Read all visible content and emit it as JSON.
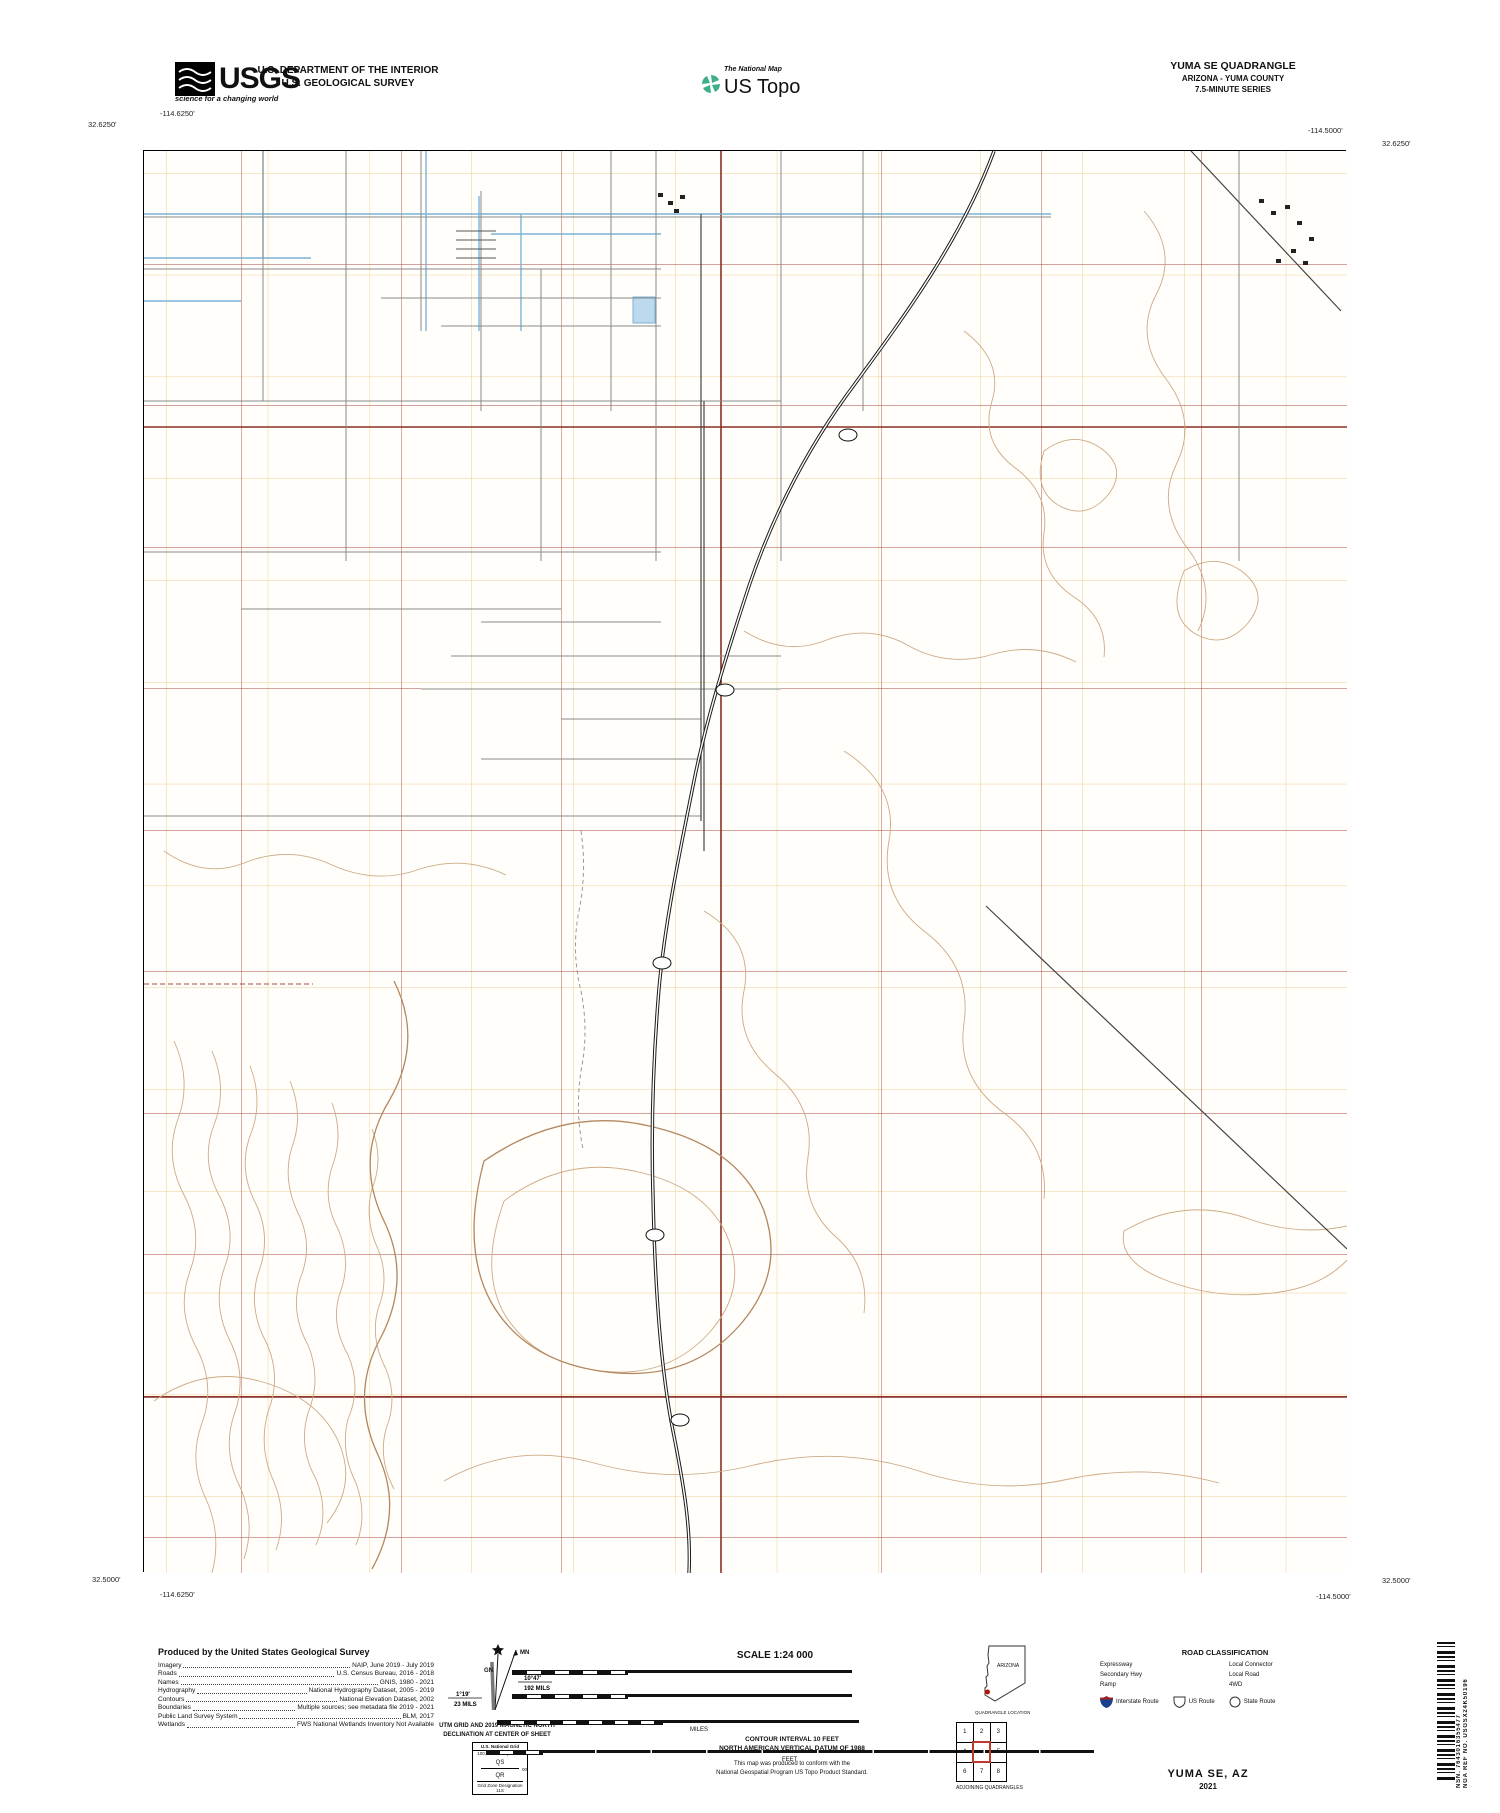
{
  "header": {
    "usgs_word": "USGS",
    "usgs_tagline": "science for a changing world",
    "dept_line1": "U.S. DEPARTMENT OF THE INTERIOR",
    "dept_line2": "U.S. GEOLOGICAL SURVEY",
    "natmap_label": "The National Map",
    "ustopo_label": "US Topo",
    "quad_title": "YUMA SE QUADRANGLE",
    "quad_subtitle1": "ARIZONA - YUMA COUNTY",
    "quad_subtitle2": "7.5-MINUTE SERIES"
  },
  "map": {
    "corners": {
      "tl_lon": "-114.6250'",
      "tl_lat": "32.6250'",
      "tr_lon": "-114.5000'",
      "tr_lat": "32.6250'",
      "bl_lat": "32.5000'",
      "bl_lon": "-114.6250'",
      "br_lon": "-114.5000'",
      "br_lat": "32.5000'"
    },
    "top_numbers": [
      {
        "t": "⁷23⁰⁰⁰ᵐE",
        "x": 168
      },
      {
        "t": "24",
        "x": 267
      },
      {
        "t": "25",
        "x": 369
      },
      {
        "t": "26",
        "x": 470
      },
      {
        "t": "27",
        "x": 572
      },
      {
        "t": "28",
        "x": 674
      },
      {
        "t": "29",
        "x": 776
      },
      {
        "t": "30",
        "x": 877
      },
      {
        "t": "31",
        "x": 979
      },
      {
        "t": "32",
        "x": 1081
      },
      {
        "t": "33",
        "x": 1183
      },
      {
        "t": "34",
        "x": 1285
      }
    ],
    "bottom_numbers": [
      {
        "t": "24",
        "x": 267
      },
      {
        "t": "25",
        "x": 369
      },
      {
        "t": "26",
        "x": 470
      },
      {
        "t": "27",
        "x": 572
      },
      {
        "t": "28",
        "x": 674
      },
      {
        "t": "29",
        "x": 776
      },
      {
        "t": "30",
        "x": 877
      },
      {
        "t": "31",
        "x": 979
      },
      {
        "t": "32",
        "x": 1081
      },
      {
        "t": "33",
        "x": 1183
      },
      {
        "t": "³34⁰⁰⁰ᵐE",
        "x": 1285
      }
    ],
    "left_numbers": [
      {
        "t": "³⁶12⁰⁰⁰ᵐN",
        "y": 172
      },
      {
        "t": "11",
        "y": 274
      },
      {
        "t": "10",
        "y": 376
      },
      {
        "t": "09",
        "y": 478
      },
      {
        "t": "08",
        "y": 580
      },
      {
        "t": "07",
        "y": 681
      },
      {
        "t": "06",
        "y": 783
      },
      {
        "t": "05",
        "y": 885
      },
      {
        "t": "04",
        "y": 987
      },
      {
        "t": "03",
        "y": 1089
      },
      {
        "t": "02",
        "y": 1191
      },
      {
        "t": "01",
        "y": 1293
      },
      {
        "t": "QS",
        "y": 1378,
        "cls": "sm"
      },
      {
        "t": "00",
        "y": 1394
      },
      {
        "t": "QR",
        "y": 1410,
        "cls": "sm"
      },
      {
        "t": "99",
        "y": 1496
      }
    ],
    "right_numbers": [
      {
        "t": "12",
        "y": 180
      },
      {
        "t": "11",
        "y": 274
      },
      {
        "t": "10",
        "y": 376
      },
      {
        "t": "09",
        "y": 478
      },
      {
        "t": "08",
        "y": 580
      },
      {
        "t": "07",
        "y": 681
      },
      {
        "t": "06",
        "y": 783
      },
      {
        "t": "05",
        "y": 885
      },
      {
        "t": "04",
        "y": 987
      },
      {
        "t": "03",
        "y": 1089
      },
      {
        "t": "02",
        "y": 1191
      },
      {
        "t": "01",
        "y": 1293
      },
      {
        "t": "QS",
        "y": 1380,
        "cls": "sm"
      },
      {
        "t": "00",
        "y": 1396
      },
      {
        "t": "QR",
        "y": 1412,
        "cls": "sm"
      },
      {
        "t": "³⁵99⁰⁰⁰ᵐN",
        "y": 1496
      }
    ],
    "township_labels": [
      {
        "t": "T9S R23W",
        "x": 362,
        "y": 257
      },
      {
        "t": "T9S R22W",
        "x": 935,
        "y": 255
      },
      {
        "t": "T10S R23W",
        "x": 288,
        "y": 790
      },
      {
        "t": "T10S R22W",
        "x": 932,
        "y": 797
      },
      {
        "t": "T11S R23W",
        "x": 388,
        "y": 1566
      },
      {
        "t": "T11S R22W",
        "x": 912,
        "y": 1566
      }
    ],
    "section_numbers": [
      {
        "t": "28",
        "x": 168,
        "y": 215
      },
      {
        "t": "27",
        "x": 320,
        "y": 215
      },
      {
        "t": "26",
        "x": 480,
        "y": 215
      },
      {
        "t": "25",
        "x": 640,
        "y": 215
      },
      {
        "t": "30",
        "x": 800,
        "y": 215
      },
      {
        "t": "29",
        "x": 960,
        "y": 215
      },
      {
        "t": "28",
        "x": 1120,
        "y": 215
      },
      {
        "t": "27",
        "x": 1272,
        "y": 215
      },
      {
        "t": "33",
        "x": 168,
        "y": 335
      },
      {
        "t": "34",
        "x": 320,
        "y": 335
      },
      {
        "t": "35",
        "x": 480,
        "y": 335
      },
      {
        "t": "36",
        "x": 640,
        "y": 335
      },
      {
        "t": "31",
        "x": 800,
        "y": 335
      },
      {
        "t": "32",
        "x": 960,
        "y": 335
      },
      {
        "t": "33",
        "x": 1120,
        "y": 335
      },
      {
        "t": "34",
        "x": 1272,
        "y": 335
      },
      {
        "t": "4",
        "x": 168,
        "y": 476
      },
      {
        "t": "3",
        "x": 320,
        "y": 476
      },
      {
        "t": "2",
        "x": 480,
        "y": 476
      },
      {
        "t": "1",
        "x": 640,
        "y": 476
      },
      {
        "t": "6",
        "x": 800,
        "y": 476
      },
      {
        "t": "5",
        "x": 960,
        "y": 476
      },
      {
        "t": "4",
        "x": 1120,
        "y": 476
      },
      {
        "t": "3",
        "x": 1272,
        "y": 476
      },
      {
        "t": "9",
        "x": 168,
        "y": 617
      },
      {
        "t": "10",
        "x": 320,
        "y": 617
      },
      {
        "t": "11",
        "x": 480,
        "y": 617
      },
      {
        "t": "12",
        "x": 640,
        "y": 617
      },
      {
        "t": "7",
        "x": 800,
        "y": 617
      },
      {
        "t": "8",
        "x": 960,
        "y": 617
      },
      {
        "t": "9",
        "x": 1120,
        "y": 617
      },
      {
        "t": "10",
        "x": 1272,
        "y": 617
      },
      {
        "t": "16",
        "x": 168,
        "y": 759
      },
      {
        "t": "15",
        "x": 320,
        "y": 759
      },
      {
        "t": "14",
        "x": 480,
        "y": 759
      },
      {
        "t": "13",
        "x": 640,
        "y": 759
      },
      {
        "t": "18",
        "x": 800,
        "y": 759
      },
      {
        "t": "17",
        "x": 960,
        "y": 759
      },
      {
        "t": "16",
        "x": 1120,
        "y": 759
      },
      {
        "t": "15",
        "x": 1272,
        "y": 759
      },
      {
        "t": "21",
        "x": 168,
        "y": 901
      },
      {
        "t": "22",
        "x": 320,
        "y": 901
      },
      {
        "t": "23",
        "x": 480,
        "y": 901
      },
      {
        "t": "24",
        "x": 640,
        "y": 901
      },
      {
        "t": "19",
        "x": 800,
        "y": 901
      },
      {
        "t": "20",
        "x": 960,
        "y": 901
      },
      {
        "t": "21",
        "x": 1120,
        "y": 901
      },
      {
        "t": "22",
        "x": 1272,
        "y": 901
      },
      {
        "t": "28",
        "x": 168,
        "y": 1042
      },
      {
        "t": "27",
        "x": 320,
        "y": 1042
      },
      {
        "t": "26",
        "x": 480,
        "y": 1042
      },
      {
        "t": "25",
        "x": 640,
        "y": 1042
      },
      {
        "t": "30",
        "x": 800,
        "y": 1042
      },
      {
        "t": "29",
        "x": 960,
        "y": 1042
      },
      {
        "t": "28",
        "x": 1120,
        "y": 1042
      },
      {
        "t": "27",
        "x": 1272,
        "y": 1042
      },
      {
        "t": "33",
        "x": 168,
        "y": 1184
      },
      {
        "t": "34",
        "x": 320,
        "y": 1184
      },
      {
        "t": "35",
        "x": 480,
        "y": 1184
      },
      {
        "t": "36",
        "x": 640,
        "y": 1184
      },
      {
        "t": "31",
        "x": 800,
        "y": 1184
      },
      {
        "t": "32",
        "x": 960,
        "y": 1184
      },
      {
        "t": "33",
        "x": 1120,
        "y": 1184
      },
      {
        "t": "34",
        "x": 1272,
        "y": 1184
      },
      {
        "t": "4",
        "x": 168,
        "y": 1497
      },
      {
        "t": "3",
        "x": 320,
        "y": 1497
      },
      {
        "t": "2",
        "x": 480,
        "y": 1497
      },
      {
        "t": "1",
        "x": 640,
        "y": 1497
      },
      {
        "t": "6",
        "x": 800,
        "y": 1497
      },
      {
        "t": "5",
        "x": 960,
        "y": 1497
      },
      {
        "t": "4",
        "x": 1120,
        "y": 1497
      },
      {
        "t": "3",
        "x": 1272,
        "y": 1497
      }
    ],
    "street_labels": [
      {
        "t": "LIMETREE LN",
        "x": 703,
        "y": 164
      },
      {
        "t": "E CO 14 1/2 ST",
        "x": 372,
        "y": 209
      },
      {
        "t": "E CO 14 3/4 ST",
        "x": 315,
        "y": 256
      },
      {
        "t": "E 15TH ST",
        "x": 452,
        "y": 266
      },
      {
        "t": "E CO 15 1/4 ST",
        "x": 400,
        "y": 294
      },
      {
        "t": "CO 15 1/2 E",
        "x": 528,
        "y": 322
      },
      {
        "t": "VERBENA ST",
        "x": 748,
        "y": 287
      },
      {
        "t": "E CO 16TH ST",
        "x": 250,
        "y": 398
      },
      {
        "t": "E CO 16TH ST",
        "x": 450,
        "y": 398
      },
      {
        "t": "E CO 17TH ST",
        "x": 235,
        "y": 548
      },
      {
        "t": "W CO ST 1/2",
        "x": 280,
        "y": 606
      },
      {
        "t": "17 3/4 ST",
        "x": 548,
        "y": 616
      },
      {
        "t": "E CO 17 3/4 ST",
        "x": 542,
        "y": 652
      },
      {
        "t": "E CO 18TH ST",
        "x": 510,
        "y": 685
      },
      {
        "t": "E CHAPARRAL WAY",
        "x": 614,
        "y": 713
      },
      {
        "t": "E CO 18 1/2 ST",
        "x": 550,
        "y": 756
      },
      {
        "t": "E CO 19TH ST",
        "x": 235,
        "y": 806
      },
      {
        "t": "E CO 19TH ST",
        "x": 655,
        "y": 812
      },
      {
        "t": "4TH AVE EXD",
        "x": 150,
        "y": 243,
        "cls": "v"
      },
      {
        "t": "S AVE 3 E",
        "x": 780,
        "y": 292,
        "cls": "v"
      },
      {
        "t": "S SIERRA SANDS DR",
        "x": 764,
        "y": 330,
        "cls": "v"
      },
      {
        "t": "S AVE 2 E",
        "x": 703,
        "y": 640,
        "cls": "v"
      },
      {
        "t": "S AVE 3 E",
        "x": 1240,
        "y": 338,
        "cls": "v"
      },
      {
        "t": "AVE 3E",
        "x": 560,
        "y": 890,
        "cls": "v"
      },
      {
        "t": "E CO 14TH ST",
        "x": 1248,
        "y": 200,
        "cls": "diag"
      }
    ],
    "water_labels": [
      {
        "t": "B.Main Lateral",
        "x": 290,
        "y": 209
      },
      {
        "t": "A Canal",
        "x": 582,
        "y": 207
      },
      {
        "t": "A No 9 Lateral",
        "x": 445,
        "y": 200,
        "cls": "v"
      },
      {
        "t": "A No 4 Lateral",
        "x": 212,
        "y": 252
      }
    ],
    "place_labels": [
      {
        "t": "BARRY GOLDWATER",
        "x": 952,
        "y": 752,
        "cls": "range"
      },
      {
        "t": "RANGE",
        "x": 952,
        "y": 767,
        "cls": "range"
      },
      {
        "t": "YUMA",
        "x": 1072,
        "y": 813,
        "cls": "city"
      },
      {
        "t": "Yuma Desert",
        "x": 590,
        "y": 1077,
        "cls": "desert"
      }
    ],
    "shields": [
      {
        "t": "195",
        "x": 848,
        "y": 435
      },
      {
        "t": "195",
        "x": 725,
        "y": 690
      },
      {
        "t": "195",
        "x": 662,
        "y": 963
      },
      {
        "t": "195",
        "x": 655,
        "y": 1235
      },
      {
        "t": "195",
        "x": 680,
        "y": 1420
      }
    ]
  },
  "footer": {
    "produced_title": "Produced by the United States Geological Survey",
    "datum_lines": [
      "North American Datum of 1983 (NAD83)",
      "World Geodetic System of 1984 (WGS84).  Projection and",
      "1 000-meter grid:Universal Transverse Mercator, Zone 11S"
    ],
    "disclaimer_lines": [
      "This map is not a legal document. Boundaries may be",
      "generalized for this map scale. Private lands within government",
      "reservations may not be shown. Obtain permission before",
      "entering private lands."
    ],
    "sources": [
      {
        "k": "Imagery",
        "v": "NAIP, June 2019 - July 2019"
      },
      {
        "k": "Roads",
        "v": "U.S. Census Bureau, 2016 - 2018"
      },
      {
        "k": "Names",
        "v": "GNIS, 1980 - 2021"
      },
      {
        "k": "Hydrography",
        "v": "National Hydrography Dataset, 2005 - 2019"
      },
      {
        "k": "Contours",
        "v": "National Elevation Dataset, 2002"
      },
      {
        "k": "Boundaries",
        "v": "Multiple sources; see metadata file 2019 - 2021"
      },
      {
        "k": "Public Land Survey System",
        "v": "BLM, 2017"
      },
      {
        "k": "Wetlands",
        "v": "FWS National Wetlands Inventory Not Available"
      }
    ],
    "declination": {
      "gn_label": "GN",
      "mn_label": "MN",
      "gn_value": "1°19'",
      "gn_mils": "23 MILS",
      "mn_value": "10°47'",
      "mn_mils": "192 MILS",
      "caption1": "UTM GRID AND 2019 MAGNETIC NORTH",
      "caption2": "DECLINATION AT CENTER OF SHEET"
    },
    "usng": {
      "title": "U.S. National Grid",
      "subtitle": "100,000 - m Square ID",
      "sq1": "QS",
      "sq2": "QR",
      "tick": "00",
      "gzd_label": "Grid Zone Designation",
      "gzd": "11S"
    },
    "scale": {
      "title": "SCALE 1:24 000",
      "km_labels": [
        {
          "t": "1",
          "x": 512
        },
        {
          "t": "0.5",
          "x": 569
        },
        {
          "t": "0",
          "x": 626
        },
        {
          "t": "KILOMETERS",
          "x": 686
        },
        {
          "t": "1",
          "x": 740
        },
        {
          "t": "2",
          "x": 852
        }
      ],
      "m_labels": [
        {
          "t": "1000",
          "x": 512
        },
        {
          "t": "500",
          "x": 569
        },
        {
          "t": "0",
          "x": 626
        },
        {
          "t": "METERS",
          "x": 686
        },
        {
          "t": "1000",
          "x": 740
        },
        {
          "t": "2000",
          "x": 852
        }
      ],
      "mi_labels": [
        {
          "t": "1",
          "x": 497
        },
        {
          "t": "0.5",
          "x": 579
        },
        {
          "t": "0",
          "x": 661
        },
        {
          "t": "1",
          "x": 859
        }
      ],
      "mi_word": "MILES",
      "ft_labels": [
        {
          "t": "1000",
          "x": 486
        },
        {
          "t": "0",
          "x": 541
        },
        {
          "t": "1000",
          "x": 596
        },
        {
          "t": "2000",
          "x": 651
        },
        {
          "t": "3000",
          "x": 707
        },
        {
          "t": "4000",
          "x": 762
        },
        {
          "t": "5000",
          "x": 817
        },
        {
          "t": "6000",
          "x": 872
        },
        {
          "t": "7000",
          "x": 928
        },
        {
          "t": "8000",
          "x": 983
        },
        {
          "t": "9000",
          "x": 1038
        },
        {
          "t": "10000",
          "x": 1094
        }
      ],
      "ft_word": "FEET"
    },
    "notes": [
      "CONTOUR INTERVAL 10 FEET",
      "NORTH AMERICAN VERTICAL DATUM OF 1988"
    ],
    "conform": [
      "This map was produced to conform with the",
      "National Geospatial Program US Topo Product Standard."
    ],
    "location": {
      "state": "ARIZONA",
      "caption": "QUADRANGLE LOCATION"
    },
    "adjoining": {
      "cells": [
        "1",
        "2",
        "3",
        "4",
        "5",
        "6",
        "7",
        "8"
      ],
      "names": [
        "1 Yuma West",
        "2 Yuma East",
        "3 Fortuna",
        "4 Somerton",
        "5 Fortuna SW",
        "6 South of Somerton",
        "7 Southeast of Somerton",
        "8 West of Vopoki Ridge"
      ],
      "caption": "ADJOINING QUADRANGLES"
    },
    "roads": {
      "title": "ROAD CLASSIFICATION",
      "col1": [
        {
          "label": "Expressway",
          "cls": "expressway"
        },
        {
          "label": "Secondary Hwy",
          "cls": "secondary"
        },
        {
          "label": "Ramp",
          "cls": "ramp"
        }
      ],
      "col2": [
        {
          "label": "Local Connector",
          "cls": "connector"
        },
        {
          "label": "Local Road",
          "cls": "local"
        },
        {
          "label": "4WD",
          "cls": "fourwd"
        }
      ],
      "interstate_label": "Interstate Route",
      "us_label": "US Route",
      "state_label": "State Route"
    },
    "map_title": "YUMA SE,  AZ",
    "map_year": "2021",
    "nsn": "NSN. 7643016355477",
    "nga": "NGA REF NO. USGSX24K50196"
  },
  "colors": {
    "section_grid": "#a8463c",
    "utm_grid": "#eccf96",
    "contour": "#cdaa85",
    "contour_index": "#b3875f",
    "water": "#7ab4d8",
    "expressway": "#7b1a12"
  }
}
